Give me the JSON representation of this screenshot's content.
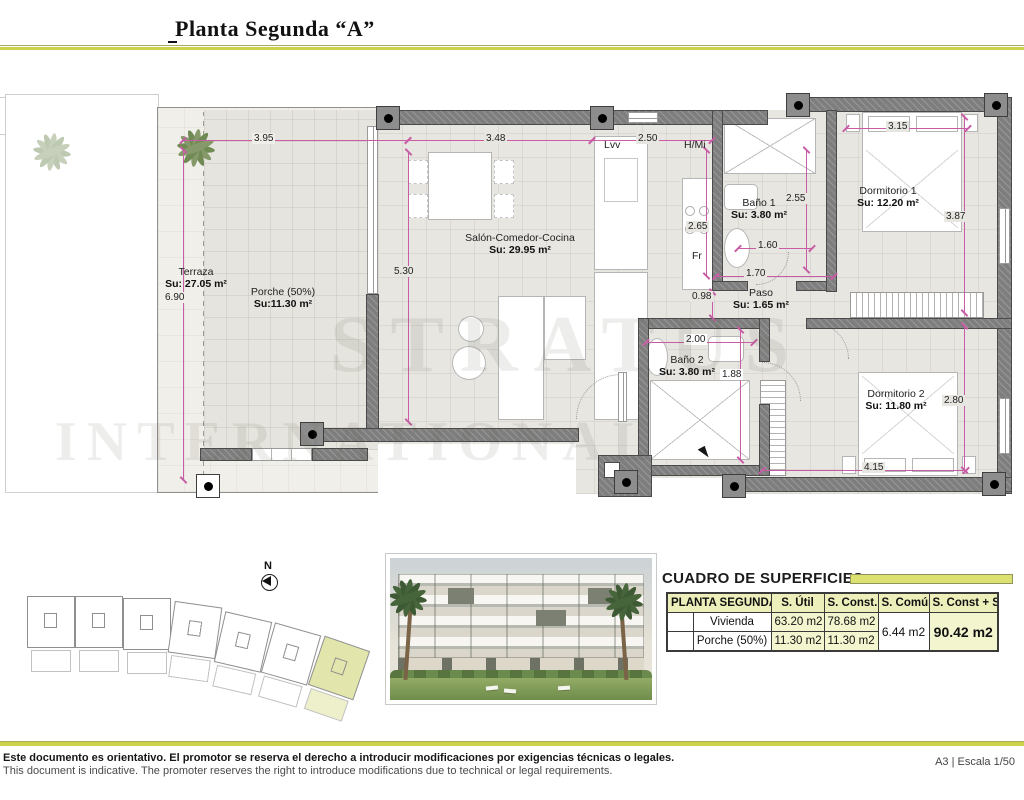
{
  "header": {
    "title": "Planta Segunda “A”"
  },
  "plan": {
    "watermark": {
      "line1": "STRATUS",
      "line2": "INTERNATIONAL"
    },
    "rooms": [
      {
        "name": "Terraza",
        "area": "Su: 27.05 m²"
      },
      {
        "name": "Porche (50%)",
        "area": "Su:11.30 m²"
      },
      {
        "name": "Salón-Comedor-Cocina",
        "area": "Su: 29.95 m²"
      },
      {
        "name": "Baño 1",
        "area": "Su: 3.80 m²"
      },
      {
        "name": "Paso",
        "area": "Su: 1.65 m²"
      },
      {
        "name": "Baño 2",
        "area": "Su: 3.80 m²"
      },
      {
        "name": "Dormitorio 1",
        "area": "Su: 12.20 m²"
      },
      {
        "name": "Dormitorio 2",
        "area": "Su: 11.80 m²"
      }
    ],
    "appliances": {
      "dishwasher": "Lvv",
      "hob_micro": "H/Mi",
      "fridge": "Fr"
    },
    "dims": {
      "d395": "3.95",
      "d348": "3.48",
      "d250": "2.50",
      "d315": "3.15",
      "d690": "6.90",
      "d530": "5.30",
      "d265": "2.65",
      "d255": "2.55",
      "d387": "3.87",
      "d280": "2.80",
      "d160": "1.60",
      "d170": "1.70",
      "d098": "0.98",
      "d200": "2.00",
      "d188": "1.88",
      "d415": "4.15"
    }
  },
  "site_plan": {
    "north_label": "N"
  },
  "surfaces_table": {
    "title": "CUADRO DE SUPERFICIES",
    "header": {
      "col_group": "PLANTA SEGUNDA",
      "col_util": "S. Útil",
      "col_const": "S. Const.",
      "col_comun": "S. Común",
      "col_total": "S. Const + S.C"
    },
    "rows": [
      {
        "name": "Vivienda",
        "util": "63.20 m2",
        "const": "78.68 m2"
      },
      {
        "name": "Porche (50%)",
        "util": "11.30 m2",
        "const": "11.30 m2"
      }
    ],
    "comun": "6.44 m2",
    "total": "90.42 m2"
  },
  "footer": {
    "disclaimer_es": "Este documento es orientativo. El promotor se reserva el derecho a introducir modificaciones por exigencias técnicas o legales.",
    "disclaimer_en": "This document is indicative. The promoter reserves the right to introduce modifications due to technical or legal requirements.",
    "scale_label": "A3 | Escala 1/50"
  },
  "colors": {
    "accent": "#ccd34a",
    "accent_pale": "#edefbb",
    "wall": "#7e7e7e",
    "dimension": "#c85da6"
  }
}
